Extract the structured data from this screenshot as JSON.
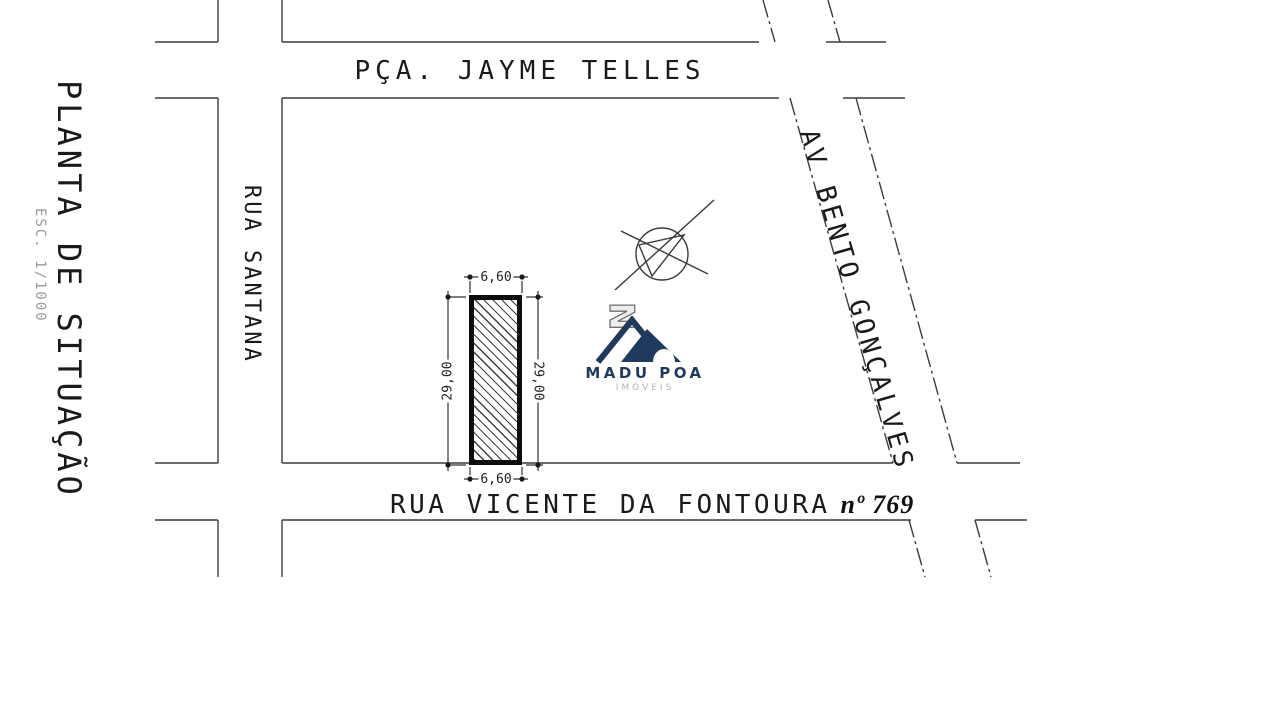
{
  "document": {
    "type_label": "PLANTA DE SITUAÇÃO",
    "scale_label": "ESC. 1/1000"
  },
  "streets": {
    "top": "PÇA. JAYME TELLES",
    "left": "RUA SANTANA",
    "diagonal": "AV BENTO GONÇALVES",
    "bottom": "RUA VICENTE DA FONTOURA",
    "bottom_number": "nº 769"
  },
  "lot": {
    "front_top": "6,60",
    "front_bottom": "6,60",
    "side_left": "29,00",
    "side_right": "29,00"
  },
  "compass": {
    "north_label": "N"
  },
  "logo": {
    "name": "MADU POA",
    "subtitle": "IMÓVEIS",
    "color": "#1f3a5c"
  },
  "colors": {
    "line": "#3c3c3c",
    "text": "#1a1a1a",
    "background": "#ffffff",
    "logo_navy": "#1f3a5c"
  }
}
